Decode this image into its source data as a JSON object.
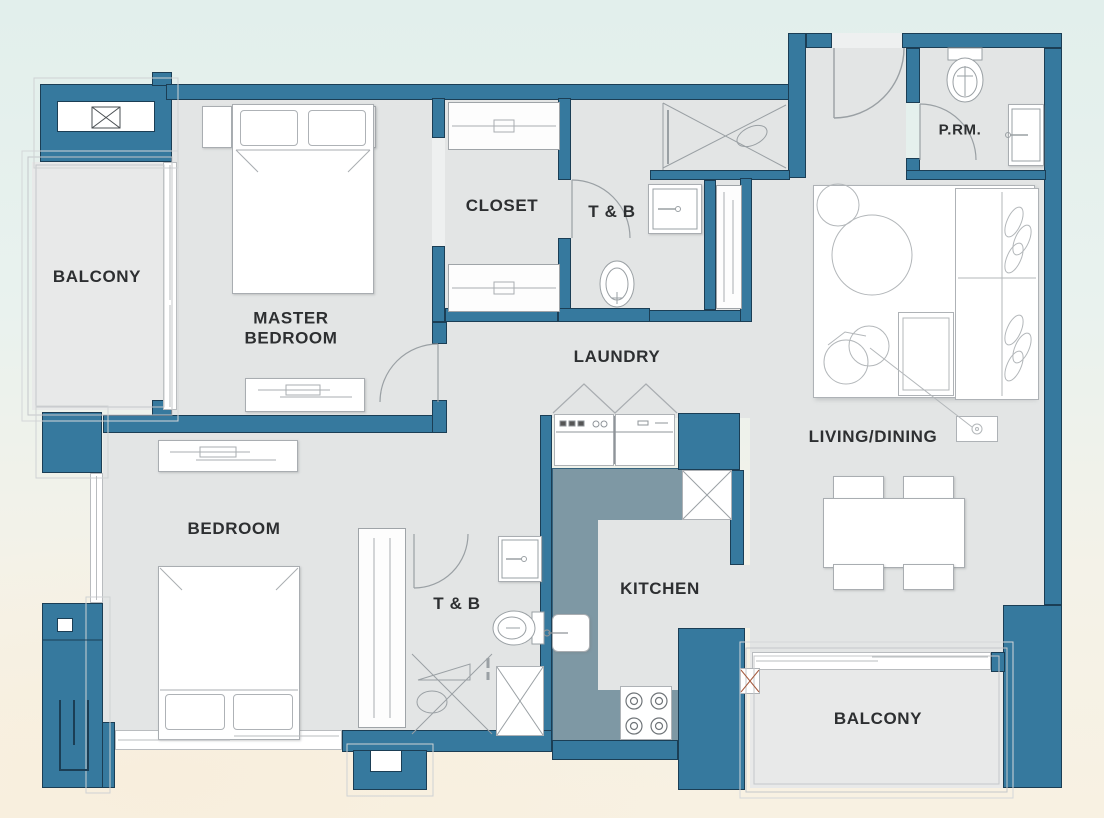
{
  "title": "Two-bedroom unit floor plan",
  "colors": {
    "wall": "#36799e",
    "wall_outline": "#1b3e55",
    "floor": "#e3e5e5",
    "balcony_floor": "#e8e9e9",
    "kitchen_counter": "#7e98a4",
    "background_top": "#e2efec",
    "background_bottom": "#f8f1e2",
    "label_text": "#2d2f31",
    "accent_x": "#a65b3f"
  },
  "rooms": {
    "balcony_left": {
      "label": "BALCONY"
    },
    "master_bedroom": {
      "label": "MASTER BEDROOM"
    },
    "closet": {
      "label": "CLOSET"
    },
    "tb_master": {
      "label": "T & B"
    },
    "laundry": {
      "label": "LAUNDRY"
    },
    "powder_room": {
      "label": "P.RM."
    },
    "living_dining": {
      "label": "LIVING/DINING"
    },
    "bedroom": {
      "label": "BEDROOM"
    },
    "tb_common": {
      "label": "T & B"
    },
    "kitchen": {
      "label": "KITCHEN"
    },
    "balcony_main": {
      "label": "BALCONY"
    }
  }
}
